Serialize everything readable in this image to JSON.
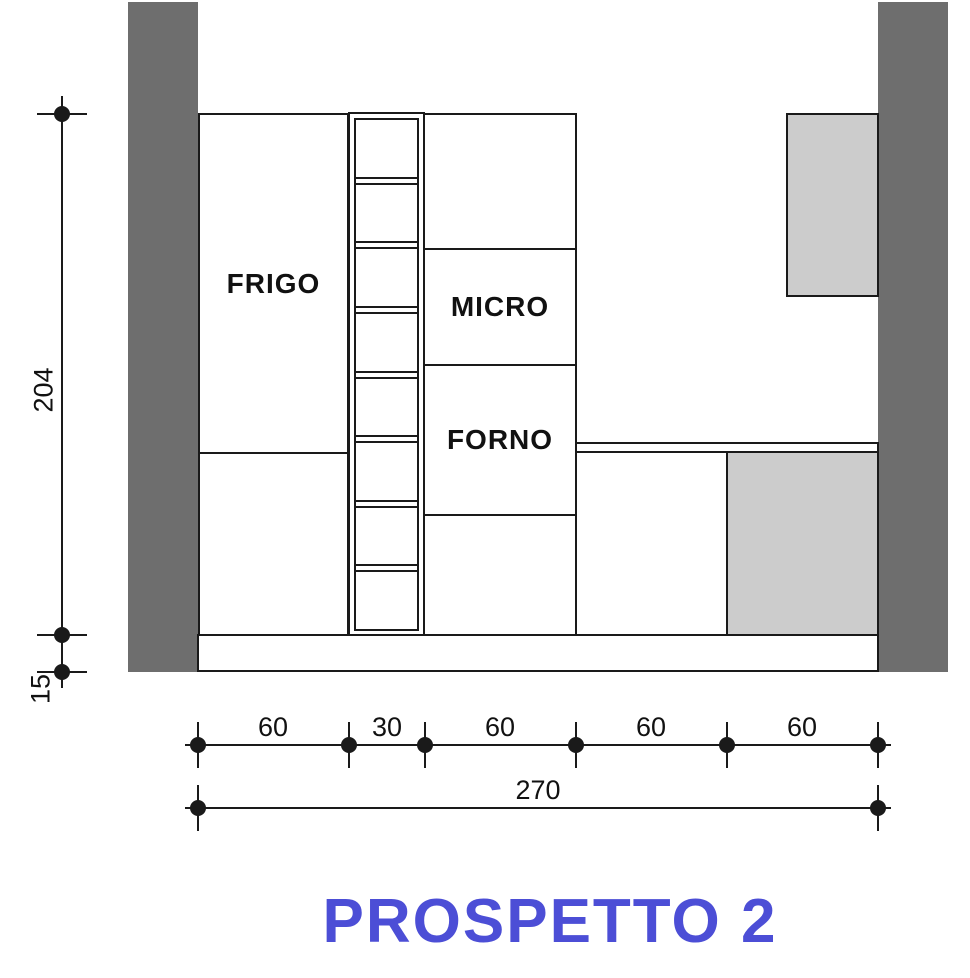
{
  "title": {
    "text": "PROSPETTO 2"
  },
  "cabinets": {
    "frigo": "FRIGO",
    "micro": "MICRO",
    "forno": "FORNO"
  },
  "dims": {
    "left": {
      "height_label": "204",
      "plinth_label": "15"
    },
    "bottom": {
      "segments": [
        "60",
        "30",
        "60",
        "60",
        "60"
      ],
      "total": "270"
    }
  },
  "shelf_unit": {
    "compartments": 8
  },
  "colors": {
    "wall_dark": "#6e6e6e",
    "cabinet_light": "#cccccc",
    "line": "#1a1a1a",
    "title_blue": "#4c4ed6"
  }
}
